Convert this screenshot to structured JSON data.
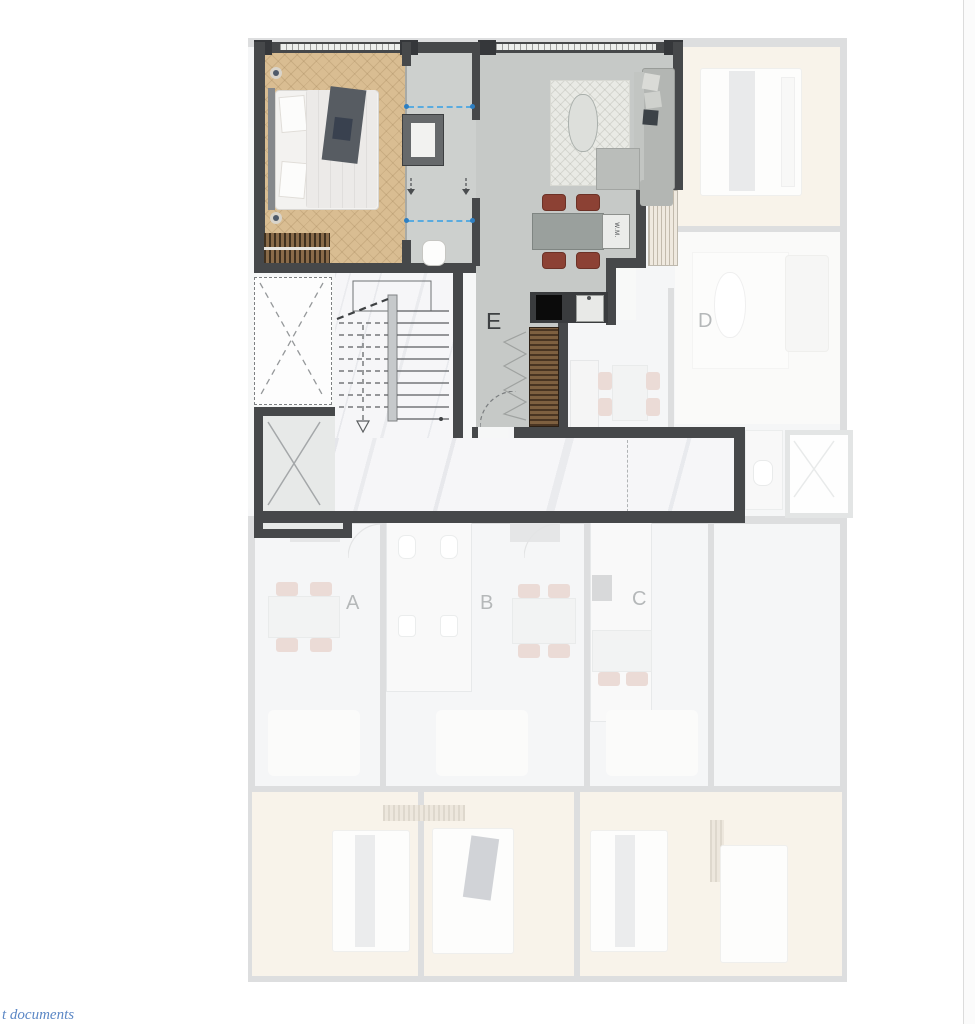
{
  "page": {
    "background": "#ffffff"
  },
  "footer_link": {
    "text": "t documents",
    "color": "#5b87c5"
  },
  "floor_plan": {
    "highlighted_unit": "E",
    "units": [
      {
        "id": "A",
        "label": "A",
        "state": "faded"
      },
      {
        "id": "B",
        "label": "B",
        "state": "faded"
      },
      {
        "id": "C",
        "label": "C",
        "state": "faded"
      },
      {
        "id": "D",
        "label": "D",
        "state": "faded"
      },
      {
        "id": "E",
        "label": "E",
        "state": "highlighted"
      }
    ],
    "labels": {
      "washer": "W.M."
    },
    "colors": {
      "highlight_wall": "#46484a",
      "wood_floor": "#d9bd92",
      "concrete_floor": "#c6c9c7",
      "marble_floor": "#f6f6f8",
      "balcony_wood": "#7e6040",
      "dining_chair": "#8c4134",
      "faded_wall": "#b4b8ba",
      "faded_wood_floor": "#f1e6d2",
      "guide_line_blue": "#5aabdf"
    }
  }
}
